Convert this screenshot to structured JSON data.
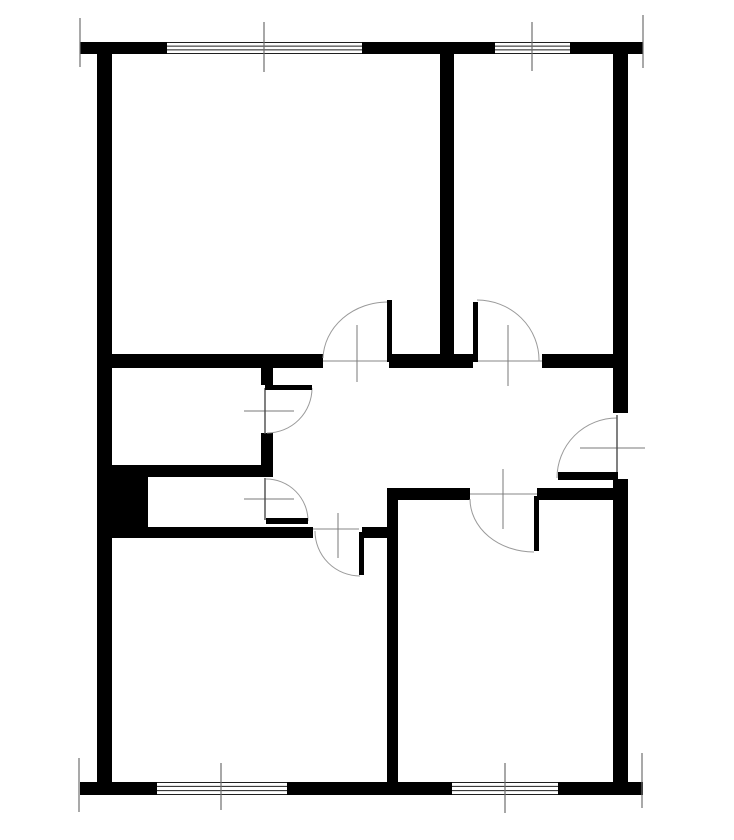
{
  "canvas": {
    "width": 734,
    "height": 840,
    "background": "#ffffff"
  },
  "palette": {
    "wall": "#000000",
    "leaf": "#000000",
    "arc": "#9a9a9a",
    "threshold": "#9f9f9f",
    "closed_door": "#4a4a4a",
    "cross": "#787878",
    "tick": "#6f6f6f",
    "window_line": "#1f1f1f",
    "window_fill": "#ffffff"
  },
  "walls": [
    {
      "name": "top-wall-left",
      "x": 80,
      "y": 42,
      "w": 87,
      "h": 12
    },
    {
      "name": "top-wall-mid",
      "x": 362,
      "y": 42,
      "w": 133,
      "h": 12
    },
    {
      "name": "top-wall-right",
      "x": 570,
      "y": 42,
      "w": 73,
      "h": 12
    },
    {
      "name": "bottom-wall-left",
      "x": 80,
      "y": 782,
      "w": 77,
      "h": 13
    },
    {
      "name": "bottom-wall-mid",
      "x": 287,
      "y": 782,
      "w": 165,
      "h": 13
    },
    {
      "name": "bottom-wall-right",
      "x": 558,
      "y": 782,
      "w": 85,
      "h": 13
    },
    {
      "name": "left-wall",
      "x": 97,
      "y": 42,
      "w": 15,
      "h": 753
    },
    {
      "name": "right-wall-upper",
      "x": 613,
      "y": 42,
      "w": 15,
      "h": 371
    },
    {
      "name": "right-wall-lower",
      "x": 613,
      "y": 479,
      "w": 15,
      "h": 316
    },
    {
      "name": "partition-top-rooms",
      "x": 440,
      "y": 42,
      "w": 14,
      "h": 318
    },
    {
      "name": "hall-north-wall-left",
      "x": 112,
      "y": 354,
      "w": 211,
      "h": 14
    },
    {
      "name": "hall-north-wall-mid",
      "x": 389,
      "y": 354,
      "w": 84,
      "h": 14
    },
    {
      "name": "hall-north-wall-right",
      "x": 542,
      "y": 354,
      "w": 71,
      "h": 14
    },
    {
      "name": "bathroom-wall-stub-upper",
      "x": 261,
      "y": 368,
      "w": 12,
      "h": 17
    },
    {
      "name": "bathroom-wall-stub-lower",
      "x": 261,
      "y": 433,
      "w": 12,
      "h": 44
    },
    {
      "name": "bathroom-wc-divider-wall",
      "x": 112,
      "y": 465,
      "w": 161,
      "h": 12
    },
    {
      "name": "duct-shaft-block",
      "x": 112,
      "y": 465,
      "w": 36,
      "h": 65
    },
    {
      "name": "hall-south-wall-left",
      "x": 112,
      "y": 527,
      "w": 201,
      "h": 11
    },
    {
      "name": "hall-south-wall-right",
      "x": 362,
      "y": 527,
      "w": 25,
      "h": 11
    },
    {
      "name": "partition-bottom-rooms",
      "x": 387,
      "y": 490,
      "w": 11,
      "h": 292
    },
    {
      "name": "bottom-right-room-north-wall-left",
      "x": 387,
      "y": 488,
      "w": 83,
      "h": 12
    },
    {
      "name": "bottom-right-room-north-wall-right",
      "x": 537,
      "y": 488,
      "w": 90,
      "h": 12
    }
  ],
  "windows": [
    {
      "name": "window-top-left",
      "x": 167,
      "y": 42,
      "w": 195,
      "h": 12
    },
    {
      "name": "window-top-right",
      "x": 495,
      "y": 42,
      "w": 75,
      "h": 12
    },
    {
      "name": "window-bottom-left",
      "x": 157,
      "y": 782,
      "w": 130,
      "h": 13
    },
    {
      "name": "window-bottom-right",
      "x": 452,
      "y": 782,
      "w": 106,
      "h": 13
    }
  ],
  "doors": [
    {
      "name": "top-left-room-door",
      "leaf": {
        "x": 387,
        "y": 300,
        "w": 5,
        "h": 62
      },
      "arc": "M323,358 A65,58 0 0 1 388,302",
      "threshold": {
        "x1": 323,
        "y1": 361,
        "x2": 387,
        "y2": 361
      },
      "cross": {
        "x1": 357,
        "y1": 325,
        "x2": 357,
        "y2": 382
      }
    },
    {
      "name": "top-right-room-door",
      "leaf": {
        "x": 473,
        "y": 302,
        "w": 5,
        "h": 60
      },
      "arc": "M477,300 A62,60 0 0 1 539,361",
      "threshold": {
        "x1": 478,
        "y1": 361,
        "x2": 542,
        "y2": 361
      },
      "cross": {
        "x1": 508,
        "y1": 325,
        "x2": 508,
        "y2": 386
      }
    },
    {
      "name": "bathroom-door",
      "leaf": {
        "x": 265,
        "y": 385,
        "w": 47,
        "h": 5
      },
      "arc": "M312,388 A45,45 0 0 1 267,433",
      "closed_line": {
        "x1": 265,
        "y1": 388,
        "x2": 265,
        "y2": 434
      },
      "cross": {
        "x1": 244,
        "y1": 411,
        "x2": 294,
        "y2": 411
      }
    },
    {
      "name": "wc-door",
      "leaf": {
        "x": 266,
        "y": 518,
        "w": 42,
        "h": 6
      },
      "arc": "M266,479 A42,42 0 0 1 308,521",
      "closed_line": {
        "x1": 265,
        "y1": 478,
        "x2": 265,
        "y2": 520
      },
      "cross": {
        "x1": 244,
        "y1": 499,
        "x2": 294,
        "y2": 499
      }
    },
    {
      "name": "bottom-left-room-door",
      "leaf": {
        "x": 359,
        "y": 532,
        "w": 5,
        "h": 43
      },
      "arc": "M315,531 A45,45 0 0 0 360,576",
      "threshold": {
        "x1": 313,
        "y1": 529,
        "x2": 359,
        "y2": 529
      },
      "cross": {
        "x1": 338,
        "y1": 513,
        "x2": 338,
        "y2": 558
      }
    },
    {
      "name": "bottom-right-room-door",
      "leaf": {
        "x": 534,
        "y": 496,
        "w": 5,
        "h": 55
      },
      "arc": "M470,499 A64,53 0 0 0 534,552",
      "threshold": {
        "x1": 470,
        "y1": 494,
        "x2": 537,
        "y2": 494
      },
      "cross": {
        "x1": 503,
        "y1": 469,
        "x2": 503,
        "y2": 529
      }
    },
    {
      "name": "entrance-door",
      "leaf": {
        "x": 558,
        "y": 472,
        "w": 60,
        "h": 8
      },
      "arc": "M617,418 A60,60 0 0 0 557,478",
      "closed_line": {
        "x1": 617,
        "y1": 415,
        "x2": 617,
        "y2": 478
      },
      "cross": {
        "x1": 580,
        "y1": 448,
        "x2": 645,
        "y2": 448
      }
    }
  ],
  "dimension_ticks": [
    {
      "name": "top-wall-left-end-tick",
      "x1": 80,
      "y1": 18,
      "x2": 80,
      "y2": 67
    },
    {
      "name": "top-wall-right-end-tick",
      "x1": 643,
      "y1": 15,
      "x2": 643,
      "y2": 68
    },
    {
      "name": "window-top-left-center-tick",
      "x1": 264,
      "y1": 22,
      "x2": 264,
      "y2": 72
    },
    {
      "name": "window-top-right-center-tick",
      "x1": 532,
      "y1": 22,
      "x2": 532,
      "y2": 71
    },
    {
      "name": "bottom-wall-left-end-tick",
      "x1": 79,
      "y1": 758,
      "x2": 79,
      "y2": 812
    },
    {
      "name": "bottom-wall-right-end-tick",
      "x1": 642,
      "y1": 753,
      "x2": 642,
      "y2": 808
    },
    {
      "name": "window-bottom-left-center-tick",
      "x1": 221,
      "y1": 763,
      "x2": 221,
      "y2": 810
    },
    {
      "name": "window-bottom-right-center-tick",
      "x1": 505,
      "y1": 763,
      "x2": 505,
      "y2": 813
    }
  ]
}
